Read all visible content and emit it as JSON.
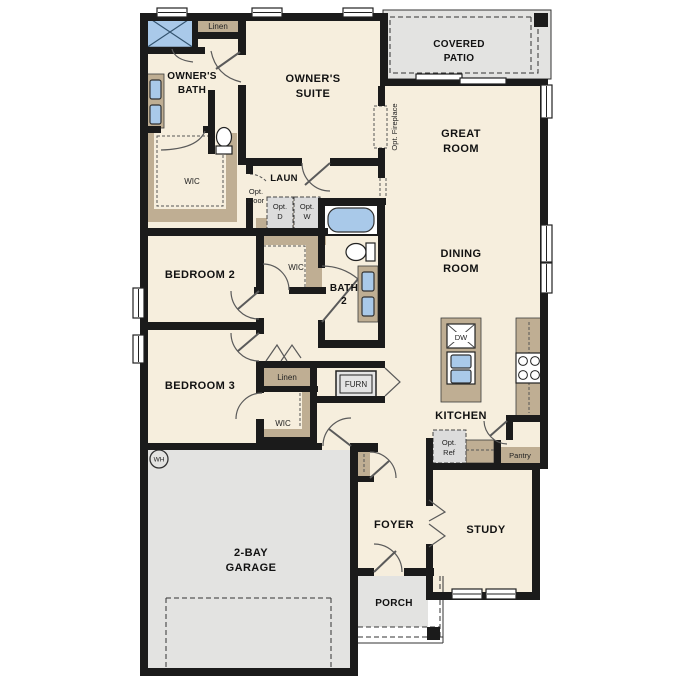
{
  "colors": {
    "floor": "#f6eedd",
    "concrete": "#e3e3e1",
    "cabinet": "#bfae93",
    "fixture_blue": "#a9c9e9",
    "wall": "#1b1b1b",
    "option_fill": "#dcdcdc"
  },
  "rooms": {
    "owners_suite": [
      "OWNER'S",
      "SUITE"
    ],
    "owners_bath": [
      "OWNER'S",
      "BATH"
    ],
    "covered_patio": [
      "COVERED",
      "PATIO"
    ],
    "great_room": [
      "GREAT",
      "ROOM"
    ],
    "dining_room": [
      "DINING",
      "ROOM"
    ],
    "bedroom_2": [
      "BEDROOM 2"
    ],
    "bedroom_3": [
      "BEDROOM 3"
    ],
    "bath_2": [
      "BATH",
      "2"
    ],
    "kitchen": [
      "KITCHEN"
    ],
    "laundry": [
      "LAUN"
    ],
    "foyer": [
      "FOYER"
    ],
    "study": [
      "STUDY"
    ],
    "porch": [
      "PORCH"
    ],
    "garage": [
      "2-BAY",
      "GARAGE"
    ]
  },
  "storage": {
    "linen_owners": "Linen",
    "wic_owners": "WIC",
    "wic_bedroom2": "WIC",
    "linen_hall": "Linen",
    "wic_bedroom3": "WIC",
    "pantry": "Pantry",
    "furnace": "FURN"
  },
  "options": {
    "opt_door": [
      "Opt.",
      "Door"
    ],
    "opt_dryer": [
      "Opt.",
      "D"
    ],
    "opt_washer": [
      "Opt.",
      "W"
    ],
    "opt_fireplace": "Opt. Fireplace",
    "opt_refrigerator": [
      "Opt.",
      "Ref"
    ]
  },
  "appliances": {
    "dishwasher": "DW",
    "water_heater": "WH"
  }
}
